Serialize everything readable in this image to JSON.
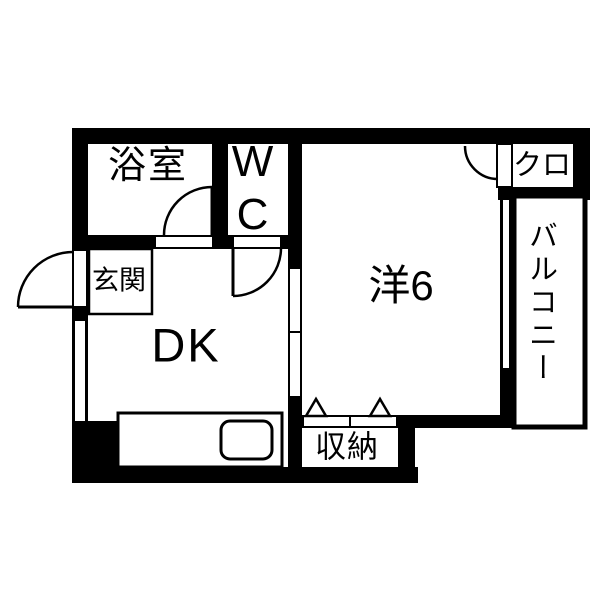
{
  "floor_plan": {
    "background_color": "#ffffff",
    "wall_color": "#000000",
    "line_color": "#000000",
    "rooms": {
      "bathroom": {
        "label": "浴室"
      },
      "toilet": {
        "label": "WC"
      },
      "entrance": {
        "label": "玄関"
      },
      "dining_kitchen": {
        "label": "DK"
      },
      "western_room": {
        "label": "洋6"
      },
      "closet": {
        "label": "クロ"
      },
      "balcony": {
        "label": "バルコニー"
      },
      "storage": {
        "label": "収納"
      }
    }
  }
}
